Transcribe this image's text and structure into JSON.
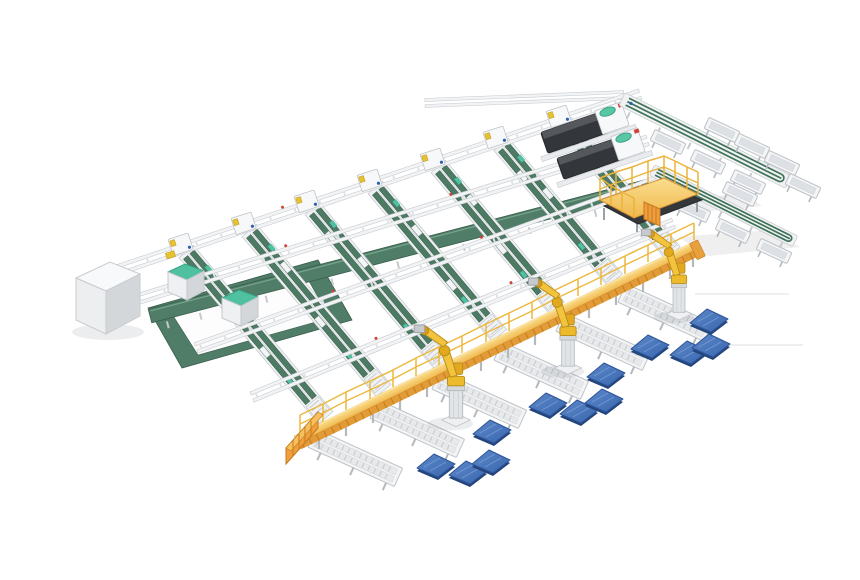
{
  "meta": {
    "title": "Automated conveyor sorting and robotic palletizing system",
    "description": "Isometric 3D render on a white background: a grid of green belt sorting conveyors with white frames, a bottom-left belt recirculation loop with two teal-top station machines, a white control cabinet, two dark processing machines, a yellow fenced operator platform with stairs, right-side outfeed belt spines with white tray stations, a long yellow elevated walkway with railings and stairs, six white roller discharge conveyors, three yellow palletizing robot arms and twelve blue pallets."
  },
  "scene": {
    "background": "#ffffff",
    "equipment": [
      {
        "name": "belt-conveyor-lines",
        "label": "Green belt sorting conveyor lines",
        "count": 7
      },
      {
        "name": "cross-transfer-rails",
        "label": "Cross transfer rail conveyors",
        "count": 5
      },
      {
        "name": "collection-belt",
        "label": "Central wide collection belt",
        "count": 1
      },
      {
        "name": "recirculation-loop",
        "label": "Belt recirculation loop",
        "count": 1
      },
      {
        "name": "station-machines",
        "label": "Teal-top station machines",
        "count": 2
      },
      {
        "name": "control-cabinet",
        "label": "Control cabinet",
        "count": 1
      },
      {
        "name": "processing-machines",
        "label": "Dark processing machines",
        "count": 2
      },
      {
        "name": "operator-platform",
        "label": "Fenced operator platform with stairs",
        "count": 1
      },
      {
        "name": "outfeed-spines",
        "label": "Outfeed belt spines",
        "count": 2
      },
      {
        "name": "outfeed-trays",
        "label": "White outfeed tray stations",
        "count": 11
      },
      {
        "name": "elevated-walkway",
        "label": "Yellow elevated walkway with railing and stairs",
        "count": 1
      },
      {
        "name": "discharge-conveyors",
        "label": "Roller discharge conveyors",
        "count": 6
      },
      {
        "name": "palletizing-robots",
        "label": "Yellow palletizing robot arms",
        "count": 3
      },
      {
        "name": "pallets",
        "label": "Blue pallets",
        "count": 12
      }
    ]
  },
  "palette": {
    "background": "#ffffff",
    "conveyor_frame": "#eff1f3",
    "conveyor_frame_edge": "#c5c9cd",
    "belt_green": "#4c7a63",
    "belt_green_dark": "#3a5d4c",
    "band_green": "#4f7d67",
    "mint_accent": "#4ec2a2",
    "walkway_yellow": "#f5c963",
    "walkway_orange": "#e29b39",
    "platform_yellow": "#eab33a",
    "robot_yellow": "#f3c33e",
    "robot_joint": "#e2a81f",
    "pallet_blue": "#3e6db4",
    "pallet_blue_dark": "#24457c",
    "machine_dark": "#33363a",
    "red_accent": "#cf4436",
    "blue_accent": "#2e5fb0",
    "leg_gray": "#b4b9bd",
    "faint_line": "#e4e5e6"
  }
}
